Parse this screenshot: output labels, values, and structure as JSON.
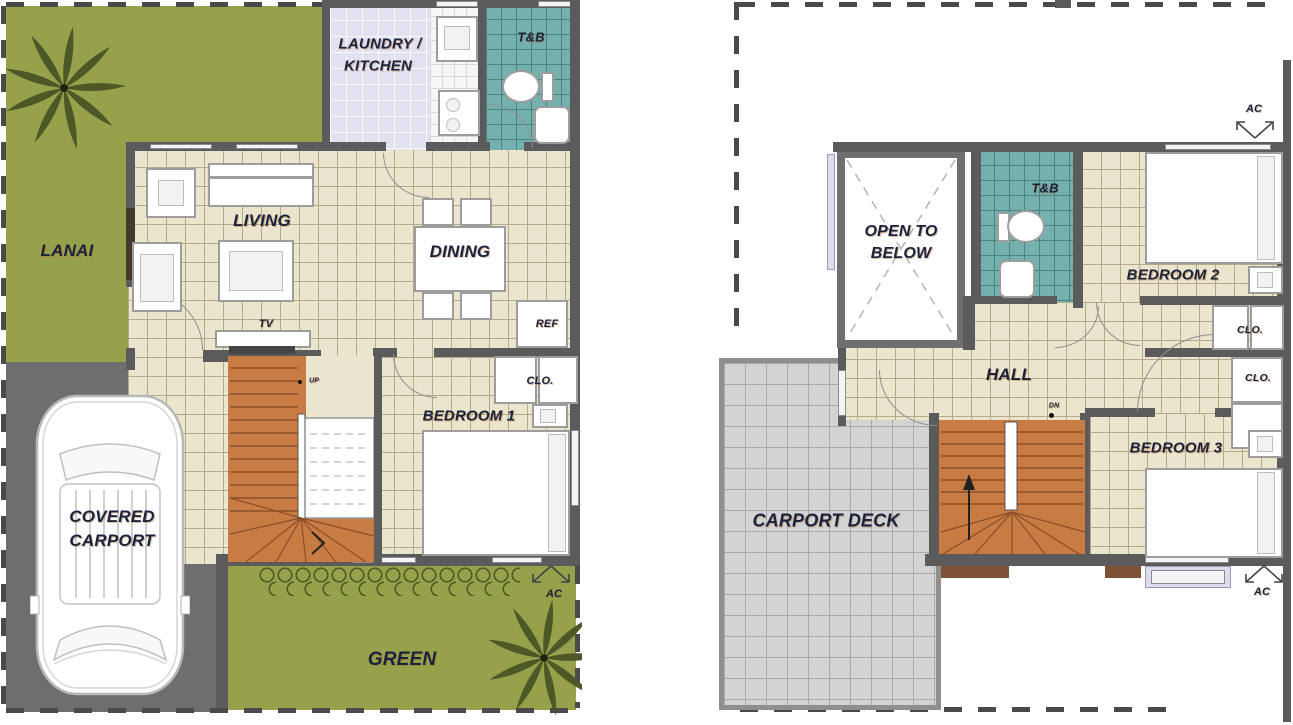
{
  "palette": {
    "grass_green": "#97a14b",
    "tile_cream": "#ece5cd",
    "bath_teal": "#74b1ae",
    "stair_orange": "#c87c44",
    "wall_gray": "#5b5b5b",
    "carport_gray": "#6e6e6e",
    "deck_gray": "#d3d3d3",
    "laundry_lavender": "#e2e1f0",
    "label_navy": "#17233f"
  },
  "gf": {
    "lanai": "LANAI",
    "laundry_line1": "LAUNDRY /",
    "laundry_line2": "KITCHEN",
    "tb": "T&B",
    "living": "LIVING",
    "dining": "DINING",
    "tv": "TV",
    "ref": "REF",
    "clo": "CLO.",
    "bedroom1": "BEDROOM 1",
    "up": "UP",
    "carport_line1": "COVERED",
    "carport_line2": "CARPORT",
    "green": "GREEN",
    "ac": "AC"
  },
  "sf": {
    "open_line1": "OPEN TO",
    "open_line2": "BELOW",
    "tb": "T&B",
    "bedroom2": "BEDROOM 2",
    "clo_bedroom2": "CLO.",
    "clo_bedroom3": "CLO.",
    "hall": "HALL",
    "dn": "DN",
    "bedroom3": "BEDROOM 3",
    "carport_deck": "CARPORT DECK",
    "ac_top": "AC",
    "ac_bottom": "AC"
  }
}
